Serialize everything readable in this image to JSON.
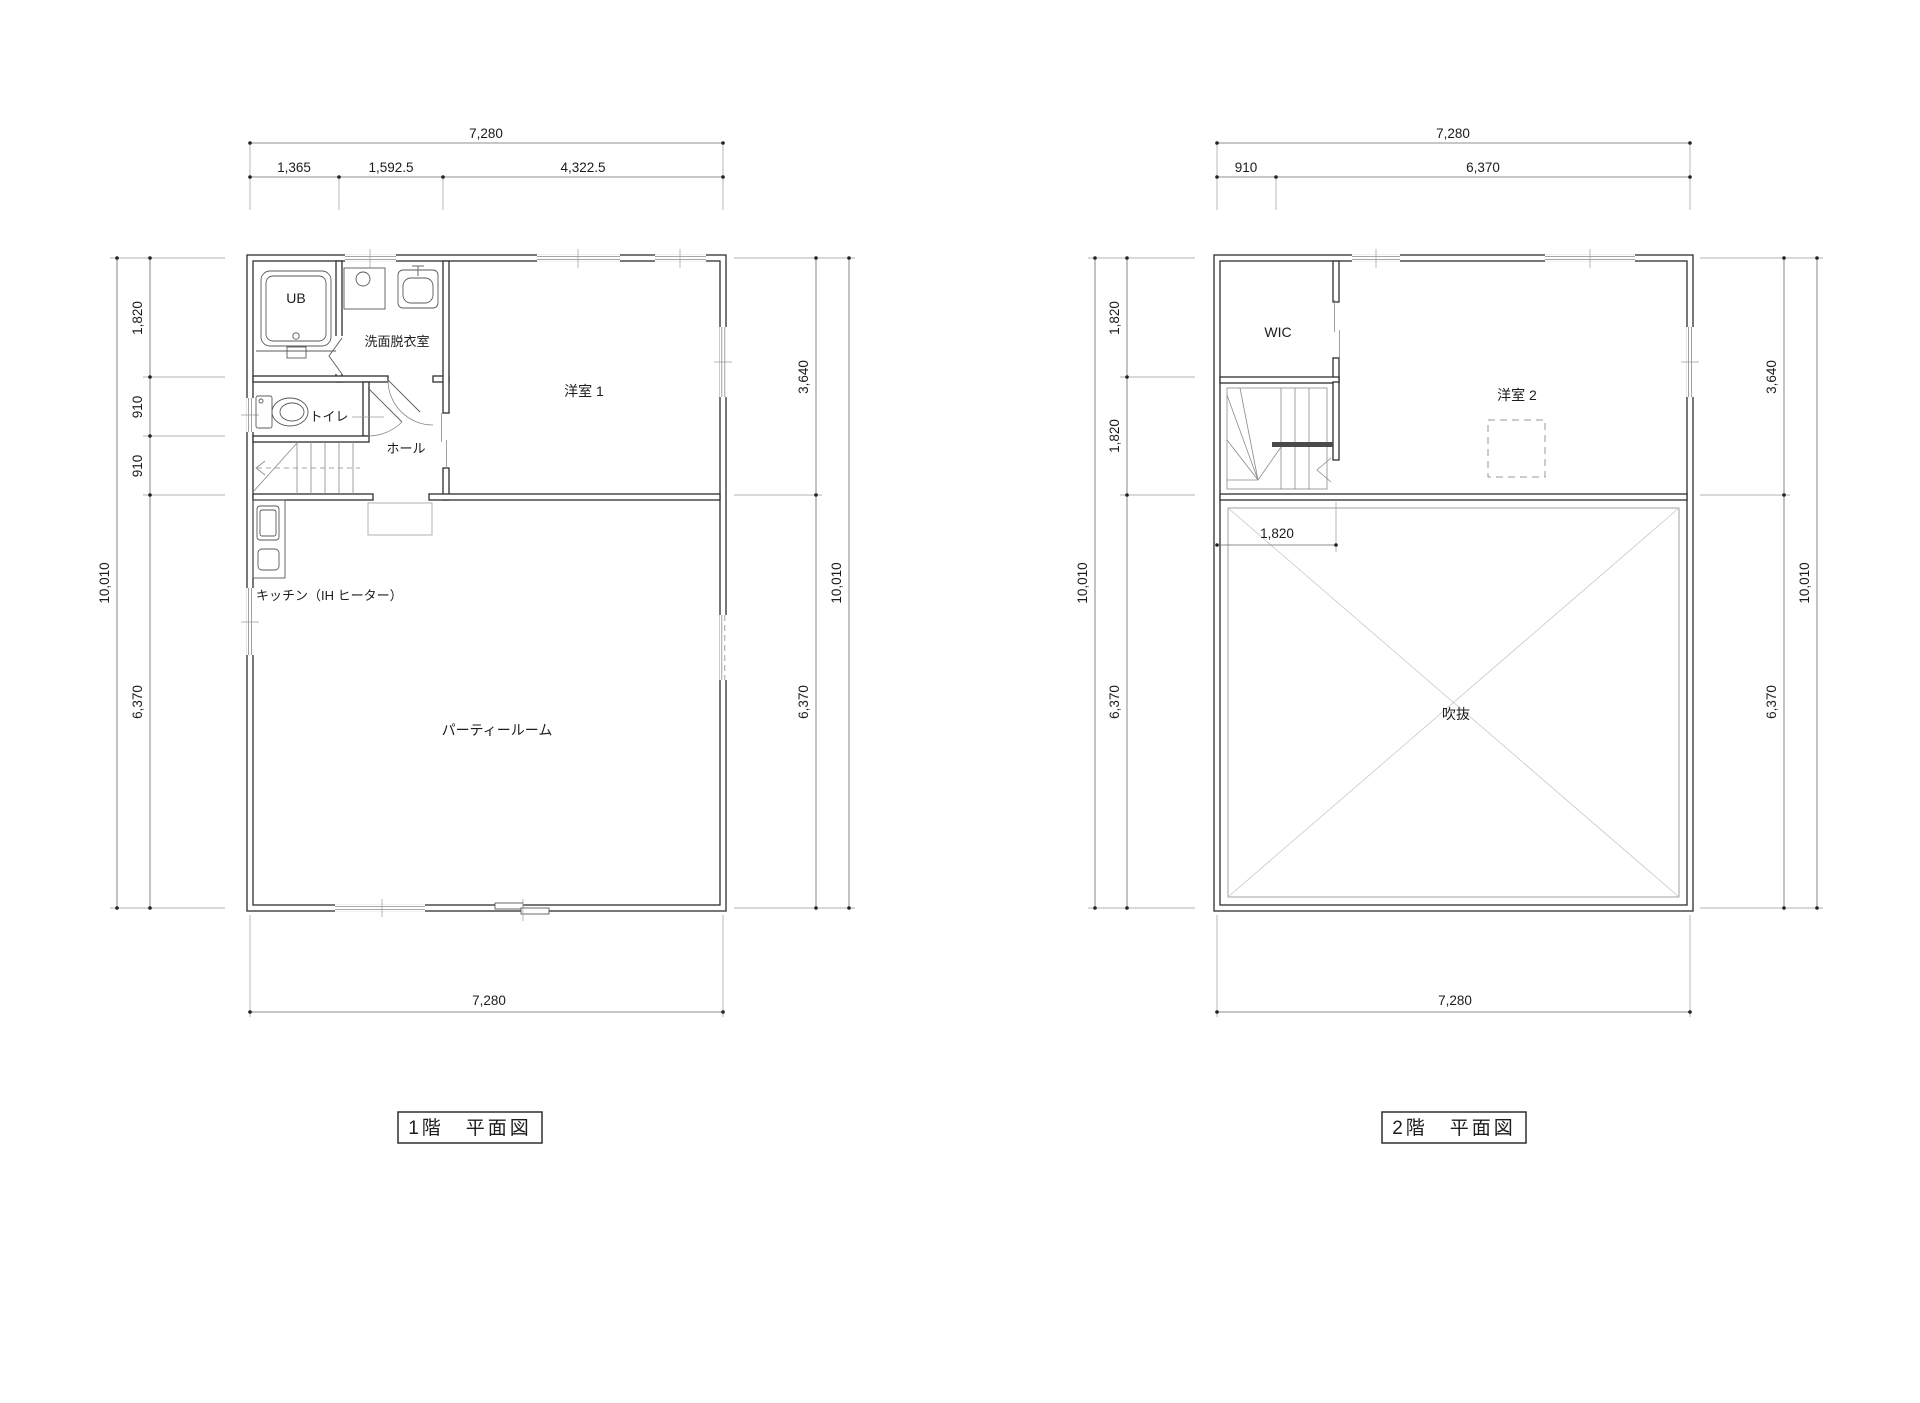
{
  "floor1": {
    "title": "1階　平面図",
    "rooms": {
      "ub": "UB",
      "washroom": "洗面脱衣室",
      "toilet": "トイレ",
      "hall": "ホール",
      "western_room_1": "洋室 1",
      "kitchen": "キッチン（IH ヒーター）",
      "party_room": "パーティールーム"
    },
    "dims": {
      "top_total": "7,280",
      "top_seg_1": "1,365",
      "top_seg_2": "1,592.5",
      "top_seg_3": "4,322.5",
      "left_total": "10,010",
      "left_seg_1": "1,820",
      "left_seg_2": "910",
      "left_seg_3": "910",
      "left_seg_4": "6,370",
      "right_seg_1": "3,640",
      "right_seg_2": "6,370",
      "right_total": "10,010",
      "bottom_total": "7,280"
    }
  },
  "floor2": {
    "title": "2階　平面図",
    "rooms": {
      "wic": "WIC",
      "western_room_2": "洋室 2",
      "void": "吹抜"
    },
    "dims": {
      "top_total": "7,280",
      "top_seg_1": "910",
      "top_seg_2": "6,370",
      "left_total": "10,010",
      "left_seg_1": "1,820",
      "left_seg_2": "1,820",
      "left_seg_3": "6,370",
      "right_seg_1": "3,640",
      "right_seg_2": "6,370",
      "right_total": "10,010",
      "bottom_total": "7,280",
      "stair_width": "1,820"
    }
  }
}
